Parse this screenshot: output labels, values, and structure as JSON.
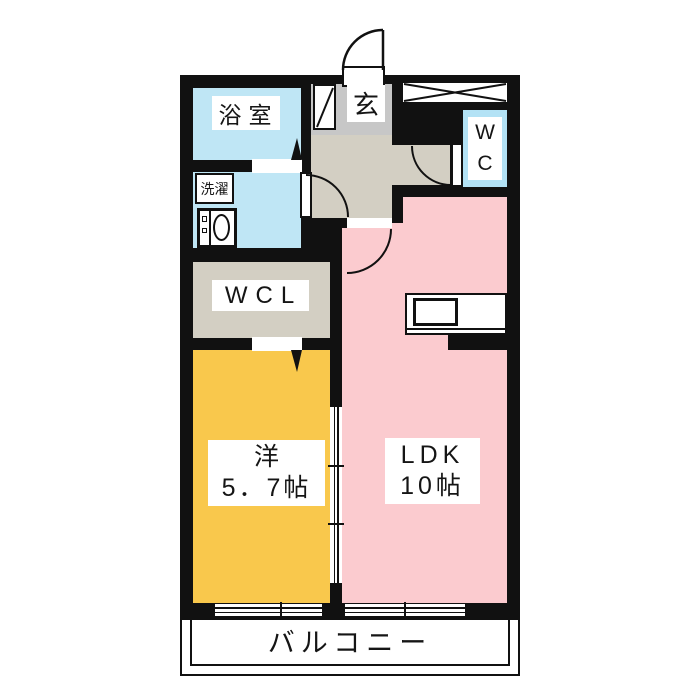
{
  "rooms": {
    "bath": {
      "label": "浴室"
    },
    "laundry": {
      "label": "洗濯"
    },
    "entrance": {
      "label": "玄"
    },
    "wc": {
      "label": "WC"
    },
    "wcl": {
      "label": "WCL"
    },
    "western_room": {
      "label": "洋",
      "size": "5．7帖"
    },
    "ldk": {
      "label": "LDK",
      "size": "10帖"
    },
    "balcony": {
      "label": "バルコニー"
    }
  },
  "colors": {
    "wall": "#111111",
    "wet_area_blue": "#bfe6f5",
    "wc_blue": "#b3e2f5",
    "hallway_beige": "#d3cfc3",
    "entrance_gray": "#c7c7c7",
    "western_yellow": "#f9c84c",
    "ldk_pink": "#fbcbcf",
    "background": "#ffffff"
  }
}
